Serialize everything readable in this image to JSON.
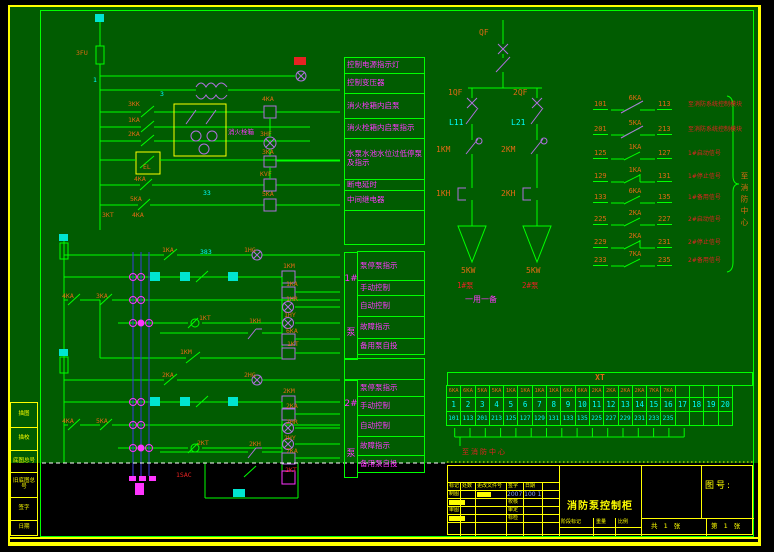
{
  "colors": {
    "bg": "#015c01",
    "line": "#00ff00",
    "accent_yellow": "#ffff00",
    "magenta": "#ff35ff",
    "orange": "#e06a14",
    "red": "#e62222",
    "cyan": "#00ffff",
    "violet": "#b070e0",
    "blue": "#3a3ae0"
  },
  "margin_labels": [
    {
      "t": "描图",
      "y": 402,
      "h": 26
    },
    {
      "t": "描校",
      "y": 427,
      "h": 24
    },
    {
      "t": "底图总号",
      "y": 450,
      "h": 23
    },
    {
      "t": "旧底图总号",
      "y": 472,
      "h": 26
    },
    {
      "t": "签字",
      "y": 497,
      "h": 24
    },
    {
      "t": "日期",
      "y": 520,
      "h": 16
    }
  ],
  "function_panel": {
    "top_rows": [
      {
        "t": "控制电源指示灯",
        "h": 17
      },
      {
        "t": "控制变压器",
        "h": 21
      },
      {
        "t": "消火栓箱内启泵",
        "h": 26
      },
      {
        "t": "消火栓箱内启泵指示",
        "h": 21
      },
      {
        "t": "水泵水池水位过低停泵及指示",
        "h": 42
      },
      {
        "t": "断电延时",
        "h": 12
      },
      {
        "t": "中间继电器",
        "h": 21
      },
      {
        "t": "",
        "h": 35
      }
    ],
    "pump1": {
      "tag": "1#",
      "unit": "泵",
      "rows": [
        {
          "t": "泵停泵指示",
          "h": 30
        },
        {
          "t": "手动控制",
          "h": 16
        },
        {
          "t": "自动控制",
          "h": 22
        },
        {
          "t": "故障指示",
          "h": 23
        },
        {
          "t": "备用泵自投",
          "h": 17
        }
      ]
    },
    "pump2": {
      "tag": "2#",
      "unit": "泵",
      "rows": [
        {
          "t": "泵停泵指示",
          "h": 18
        },
        {
          "t": "手动控制",
          "h": 20
        },
        {
          "t": "自动控制",
          "h": 22
        },
        {
          "t": "故障指示",
          "h": 20
        },
        {
          "t": "备用泵自投",
          "h": 18
        }
      ]
    }
  },
  "ladder_labels": [
    {
      "t": "3FU",
      "x": 76,
      "y": 50,
      "c": "org"
    },
    {
      "t": "1",
      "x": 93,
      "y": 77,
      "c": "cy"
    },
    {
      "t": "3",
      "x": 160,
      "y": 91,
      "c": "cy"
    },
    {
      "t": "3KK",
      "x": 128,
      "y": 101,
      "c": "org"
    },
    {
      "t": "1KA",
      "x": 128,
      "y": 117,
      "c": "org"
    },
    {
      "t": "2KA",
      "x": 128,
      "y": 131,
      "c": "org"
    },
    {
      "t": "消火栓箱",
      "x": 228,
      "y": 129,
      "c": "mag"
    },
    {
      "t": "EL",
      "x": 143,
      "y": 164,
      "c": "org"
    },
    {
      "t": "4KA",
      "x": 262,
      "y": 96,
      "c": "org"
    },
    {
      "t": "3HF",
      "x": 260,
      "y": 131,
      "c": "org"
    },
    {
      "t": "3KA",
      "x": 262,
      "y": 149,
      "c": "org"
    },
    {
      "t": "KVF",
      "x": 260,
      "y": 171,
      "c": "org"
    },
    {
      "t": "5KA",
      "x": 262,
      "y": 191,
      "c": "org"
    },
    {
      "t": "33",
      "x": 203,
      "y": 190,
      "c": "cy"
    },
    {
      "t": "3KT",
      "x": 102,
      "y": 212,
      "c": "org"
    },
    {
      "t": "4KA",
      "x": 132,
      "y": 212,
      "c": "org"
    },
    {
      "t": "4KA",
      "x": 134,
      "y": 176,
      "c": "org"
    },
    {
      "t": "5KA",
      "x": 130,
      "y": 196,
      "c": "org"
    },
    {
      "t": "1KA",
      "x": 162,
      "y": 247,
      "c": "org"
    },
    {
      "t": "383",
      "x": 200,
      "y": 249,
      "c": "cy"
    },
    {
      "t": "1HG",
      "x": 244,
      "y": 247,
      "c": "org"
    },
    {
      "t": "1KM",
      "x": 283,
      "y": 263,
      "c": "org"
    },
    {
      "t": "1KA",
      "x": 286,
      "y": 281,
      "c": "org"
    },
    {
      "t": "1HR",
      "x": 286,
      "y": 296,
      "c": "org"
    },
    {
      "t": "1HY",
      "x": 284,
      "y": 312,
      "c": "org"
    },
    {
      "t": "6KA",
      "x": 286,
      "y": 328,
      "c": "org"
    },
    {
      "t": "1KT",
      "x": 287,
      "y": 341,
      "c": "org"
    },
    {
      "t": "1KH",
      "x": 249,
      "y": 318,
      "c": "org"
    },
    {
      "t": "1KT",
      "x": 199,
      "y": 315,
      "c": "org"
    },
    {
      "t": "1KM",
      "x": 180,
      "y": 349,
      "c": "org"
    },
    {
      "t": "4KA",
      "x": 62,
      "y": 293,
      "c": "org"
    },
    {
      "t": "3KA",
      "x": 96,
      "y": 293,
      "c": "org"
    },
    {
      "t": "2KA",
      "x": 162,
      "y": 372,
      "c": "org"
    },
    {
      "t": "2HG",
      "x": 244,
      "y": 372,
      "c": "org"
    },
    {
      "t": "2KM",
      "x": 283,
      "y": 388,
      "c": "org"
    },
    {
      "t": "2KA",
      "x": 286,
      "y": 403,
      "c": "org"
    },
    {
      "t": "2HR",
      "x": 286,
      "y": 419,
      "c": "org"
    },
    {
      "t": "2HY",
      "x": 284,
      "y": 435,
      "c": "org"
    },
    {
      "t": "7KA",
      "x": 286,
      "y": 448,
      "c": "org"
    },
    {
      "t": "2KH",
      "x": 249,
      "y": 441,
      "c": "org"
    },
    {
      "t": "2KT",
      "x": 197,
      "y": 440,
      "c": "org"
    },
    {
      "t": "4KA",
      "x": 62,
      "y": 418,
      "c": "org"
    },
    {
      "t": "5KA",
      "x": 96,
      "y": 418,
      "c": "org"
    },
    {
      "t": "1SAC",
      "x": 176,
      "y": 472,
      "c": "red"
    },
    {
      "t": "2KT",
      "x": 285,
      "y": 467,
      "c": "red"
    }
  ],
  "single_line": {
    "qf": "QF",
    "qf1": "1QF",
    "qf2": "2QF",
    "l1": "L11",
    "l2": "L21",
    "km1": "1KM",
    "km2": "2KM",
    "kh1": "1KH",
    "kh2": "2KH",
    "kw1": "5KW",
    "kw2": "5KW",
    "p1": "1#泵",
    "p2": "2#泵",
    "note": "一用一备"
  },
  "contact_list": {
    "rows": [
      {
        "left": "101",
        "ka": "6KA",
        "right": "113",
        "note": "至消防系统控制模块",
        "cls": "co",
        "y": 98
      },
      {
        "left": "201",
        "ka": "5KA",
        "right": "213",
        "note": "至消防系统控制模块",
        "cls": "co",
        "y": 123
      },
      {
        "left": "125",
        "ka": "1KA",
        "right": "127",
        "note": "1#启动信号",
        "cls": "no",
        "y": 147
      },
      {
        "left": "129",
        "ka": "1KA",
        "right": "131",
        "note": "1#停止信号",
        "cls": "nc",
        "y": 170
      },
      {
        "left": "133",
        "ka": "6KA",
        "right": "135",
        "note": "1#备用信号",
        "cls": "no",
        "y": 191
      },
      {
        "left": "225",
        "ka": "2KA",
        "right": "227",
        "note": "2#启动信号",
        "cls": "no",
        "y": 213
      },
      {
        "left": "229",
        "ka": "2KA",
        "right": "231",
        "note": "2#停止信号",
        "cls": "nc",
        "y": 236
      },
      {
        "left": "233",
        "ka": "7KA",
        "right": "235",
        "note": "2#备用信号",
        "cls": "no",
        "y": 254
      }
    ],
    "brace_label": "至消防中心"
  },
  "xt": {
    "title": "XT",
    "cols": [
      {
        "ka": "6KA",
        "num": "1",
        "term": "101"
      },
      {
        "ka": "6KA",
        "num": "2",
        "term": "113"
      },
      {
        "ka": "5KA",
        "num": "3",
        "term": "201"
      },
      {
        "ka": "5KA",
        "num": "4",
        "term": "213"
      },
      {
        "ka": "1KA",
        "num": "5",
        "term": "125"
      },
      {
        "ka": "1KA",
        "num": "6",
        "term": "127"
      },
      {
        "ka": "1KA",
        "num": "7",
        "term": "129"
      },
      {
        "ka": "1KA",
        "num": "8",
        "term": "131"
      },
      {
        "ka": "6KA",
        "num": "9",
        "term": "133"
      },
      {
        "ka": "6KA",
        "num": "10",
        "term": "135"
      },
      {
        "ka": "2KA",
        "num": "11",
        "term": "225"
      },
      {
        "ka": "2KA",
        "num": "12",
        "term": "227"
      },
      {
        "ka": "2KA",
        "num": "13",
        "term": "229"
      },
      {
        "ka": "2KA",
        "num": "14",
        "term": "231"
      },
      {
        "ka": "7KA",
        "num": "15",
        "term": "233"
      },
      {
        "ka": "7KA",
        "num": "16",
        "term": "235"
      },
      {
        "ka": "",
        "num": "17",
        "term": ""
      },
      {
        "ka": "",
        "num": "18",
        "term": ""
      },
      {
        "ka": "",
        "num": "19",
        "term": ""
      },
      {
        "ka": "",
        "num": "20",
        "term": ""
      }
    ],
    "below": "至消防中心"
  },
  "titleblock": {
    "title": "消防泵控制柜",
    "drawing_no_label": "图号:",
    "header": [
      "标记",
      "处数",
      "更改文件号",
      "签字",
      "日期"
    ],
    "r1c1": "制图",
    "date": "2007 100 1",
    "r2c2": "校核",
    "r3c1": "审图",
    "r3c2": "审定",
    "r4c2": "标检",
    "stage": "阶段标记",
    "weight": "重量",
    "scale": "比例",
    "sheets": "共 1 张",
    "sheet_no": "第 1 张"
  }
}
